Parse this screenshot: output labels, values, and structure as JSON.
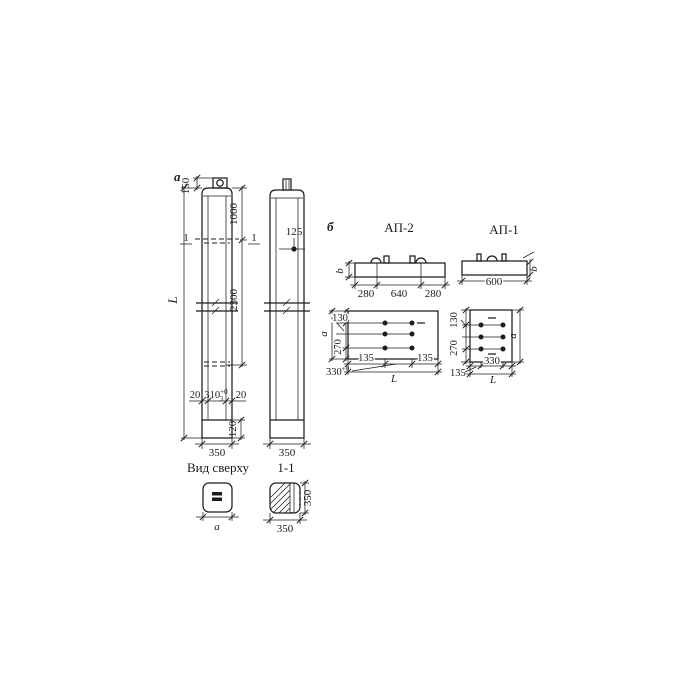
{
  "labels": {
    "panel_a": "а",
    "panel_b": "б",
    "top_view": "Вид сверху",
    "section_label": "1-1",
    "ap2_title": "АП-2",
    "ap1_title": "АП-1"
  },
  "col1": {
    "loop_height": "150",
    "length": "L",
    "to_section": "1000",
    "to_hole": "2300",
    "section_mark_left": "1",
    "section_mark_right": "1",
    "wall_left": "20",
    "slot": "310",
    "slot_sup": "+0",
    "slot_sub": "3",
    "wall_right": "20",
    "bottom_inset": "120",
    "width": "350"
  },
  "col2": {
    "hole_offset": "125",
    "width": "350"
  },
  "top_view": {
    "width": "a"
  },
  "section": {
    "height": "350",
    "width": "350"
  },
  "ap2_elev": {
    "height": "b",
    "left": "280",
    "mid": "640",
    "right": "280"
  },
  "ap2_plan": {
    "top": "130",
    "height": "a",
    "rows": "270",
    "gap": "330",
    "gap_sup": "+0",
    "edge_left": "135",
    "edge_right": "135",
    "length": "L"
  },
  "ap1_elev": {
    "length": "600",
    "height": "b"
  },
  "ap1_plan": {
    "top": "130",
    "rows": "270",
    "height": "a",
    "gap": "330",
    "edge": "135",
    "length": "L"
  }
}
